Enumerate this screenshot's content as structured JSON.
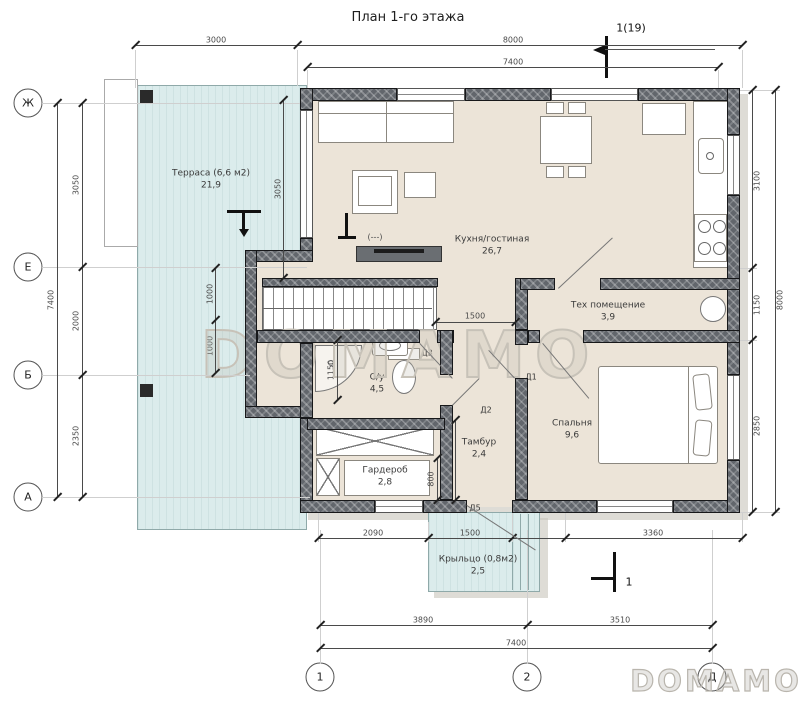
{
  "title": "План 1-го этажа",
  "section": {
    "top_label": "1(19)",
    "bottom_label": "1"
  },
  "grid": {
    "row_zh": "Ж",
    "row_e": "Е",
    "row_b": "Б",
    "row_a": "А",
    "col_1": "1",
    "col_2": "2",
    "col_d": "Д"
  },
  "rooms": {
    "terrace": {
      "name": "Терраса (6,6 м2)",
      "area": "21,9"
    },
    "kitchen_living": {
      "name": "Кухня/гостиная",
      "area": "26,7"
    },
    "tech": {
      "name": "Тех помещение",
      "area": "3,9"
    },
    "bathroom": {
      "name": "С/у",
      "area": "4,5"
    },
    "vestibule": {
      "name": "Тамбур",
      "area": "2,4"
    },
    "wardrobe": {
      "name": "Гардероб",
      "area": "2,8"
    },
    "bedroom": {
      "name": "Спальня",
      "area": "9,6"
    },
    "porch": {
      "name": "Крыльцо (0,8м2)",
      "area": "2,5"
    }
  },
  "dims": {
    "top_3000": "3000",
    "top_8000": "8000",
    "top_7400": "7400",
    "left_7400": "7400",
    "left_3050": "3050",
    "left_2000": "2000",
    "left_2350": "2350",
    "right_8000": "8000",
    "right_3100": "3100",
    "right_1150": "1150",
    "right_2850": "2850",
    "bot_2090": "2090",
    "bot_1500": "1500",
    "bot_3360": "3360",
    "bot_3890": "3890",
    "bot_3510": "3510",
    "bot_7400": "7400",
    "int_3050": "3050",
    "int_1000a": "1000",
    "int_1000b": "1000",
    "int_1500": "1500",
    "int_1150": "1150",
    "int_1600": "1600",
    "int_800": "800"
  },
  "doors": {
    "d1": "Д1",
    "d2": "Д2",
    "d3": "Д3",
    "d5": "Д5"
  },
  "level_mark": "(---)",
  "watermark": {
    "center": "DOMAMO",
    "corner": "DOMAMO"
  },
  "colors": {
    "terrace_fill": "#dbecec",
    "floor_fill": "#ece4d8",
    "wall_fill": "#62666c",
    "shadow": "#c8c4bb",
    "line": "#4a4a4a"
  }
}
